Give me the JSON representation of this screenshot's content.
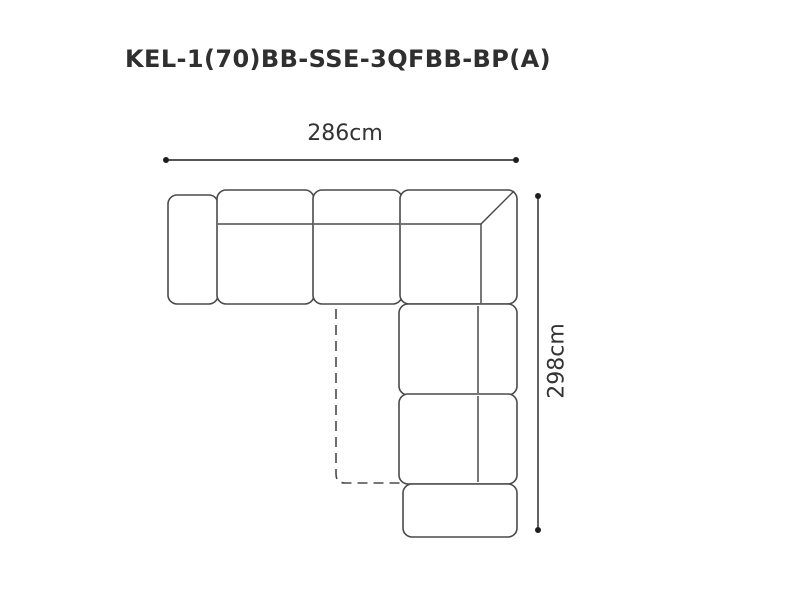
{
  "title": "KEL-1(70)BB-SSE-3QFBB-BP(A)",
  "dimensions": {
    "width_label": "286cm",
    "height_label": "298cm"
  },
  "diagram": {
    "type": "sofa-top-view-plan",
    "modules": [
      "left-armrest",
      "seat-module-1",
      "seat-module-2",
      "corner-module",
      "right-seat-module-1",
      "right-seat-module-2",
      "bottom-armrest",
      "fold-out-dashed-outline"
    ]
  },
  "colors": {
    "outline": "#4a4a4a",
    "dimension": "#1e1e1e",
    "text": "#333333",
    "title": "#2f2f2f",
    "background": "#ffffff"
  }
}
